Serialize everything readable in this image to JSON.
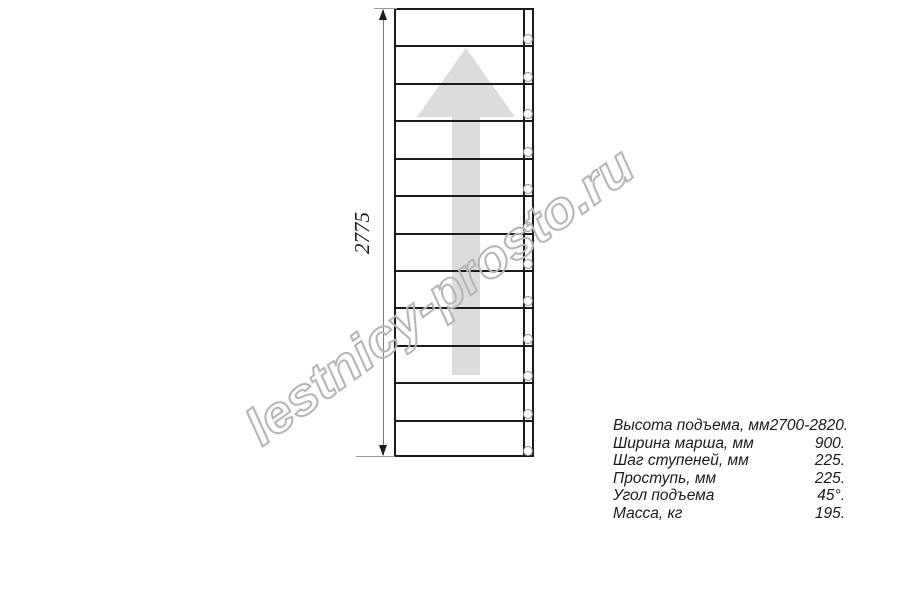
{
  "watermark": {
    "text": "lestnicy-prosto.ru",
    "color": "#b6b6b6"
  },
  "drawing": {
    "dimension_label": "2775",
    "steps_count": 12,
    "colors": {
      "line": "#1b1b1b",
      "arrow_fill": "#dcdcdc",
      "circle": "#8f8f8f",
      "dimension": "#7a7a7a"
    }
  },
  "specs": {
    "rows": [
      {
        "label": "Высота подъема, мм",
        "value": "2700-2820."
      },
      {
        "label": "Ширина марша, мм",
        "value": "900."
      },
      {
        "label": "Шаг ступеней, мм",
        "value": "225."
      },
      {
        "label": "Проступь, мм",
        "value": "225."
      },
      {
        "label": "Угол подъема",
        "value": "45°."
      },
      {
        "label": "Масса, кг",
        "value": "195."
      }
    ]
  }
}
